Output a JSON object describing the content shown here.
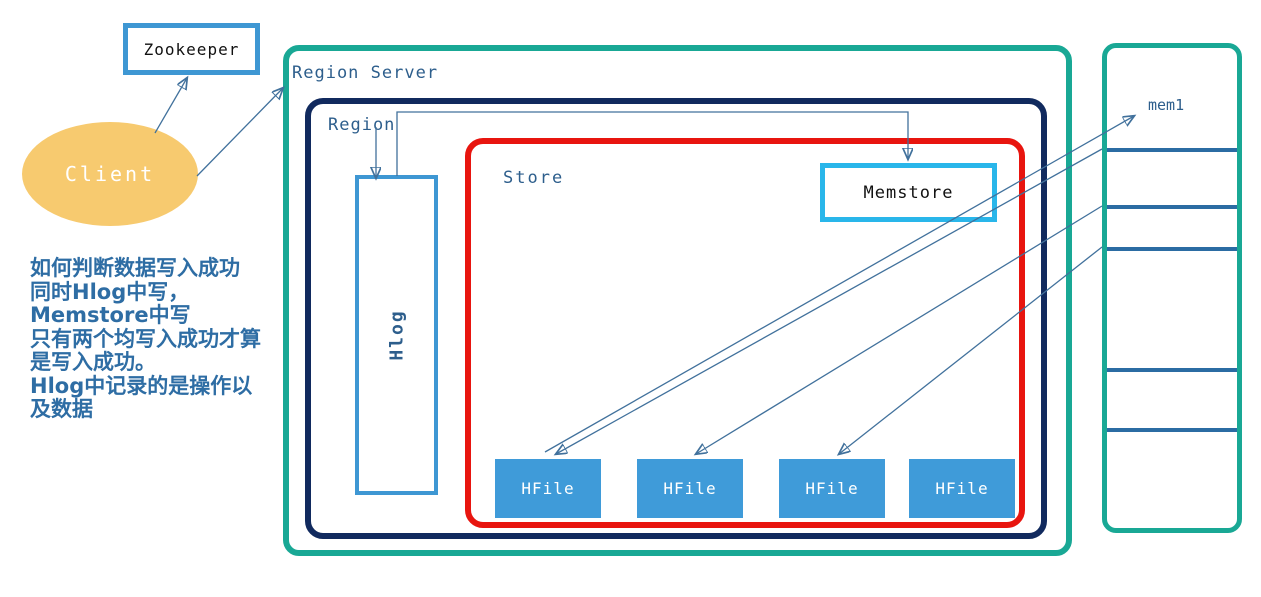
{
  "diagram_title": "HBase Region Server write path",
  "nodes": {
    "zookeeper": {
      "label": "Zookeeper"
    },
    "client": {
      "label": "Client"
    },
    "region_server": {
      "label": "Region Server"
    },
    "region": {
      "label": "Region"
    },
    "store": {
      "label": "Store"
    },
    "hlog": {
      "label": "Hlog"
    },
    "memstore": {
      "label": "Memstore"
    },
    "hfiles": [
      "HFile",
      "HFile",
      "HFile",
      "HFile"
    ],
    "mem_column": {
      "label": "mem1"
    }
  },
  "note": {
    "lines": [
      "如何判断数据写入成功",
      "同时Hlog中写，",
      "Memstore中写",
      "只有两个均写入成功才算",
      "是写入成功。",
      "Hlog中记录的是操作以",
      "及数据"
    ]
  },
  "colors": {
    "region_server_border": "#19A895",
    "region_border": "#112A5E",
    "store_border": "#E8150F",
    "hlog_border": "#3E97D3",
    "zookeeper_border": "#3E97D3",
    "memstore_border": "#29B6EA",
    "hfile_fill": "#3F9BD9",
    "client_fill": "#F7CA6F",
    "label_text": "#2D5E8C",
    "note_text": "#2E6DA4",
    "arrow": "#41719C",
    "column_divider": "#2B6CA3"
  }
}
